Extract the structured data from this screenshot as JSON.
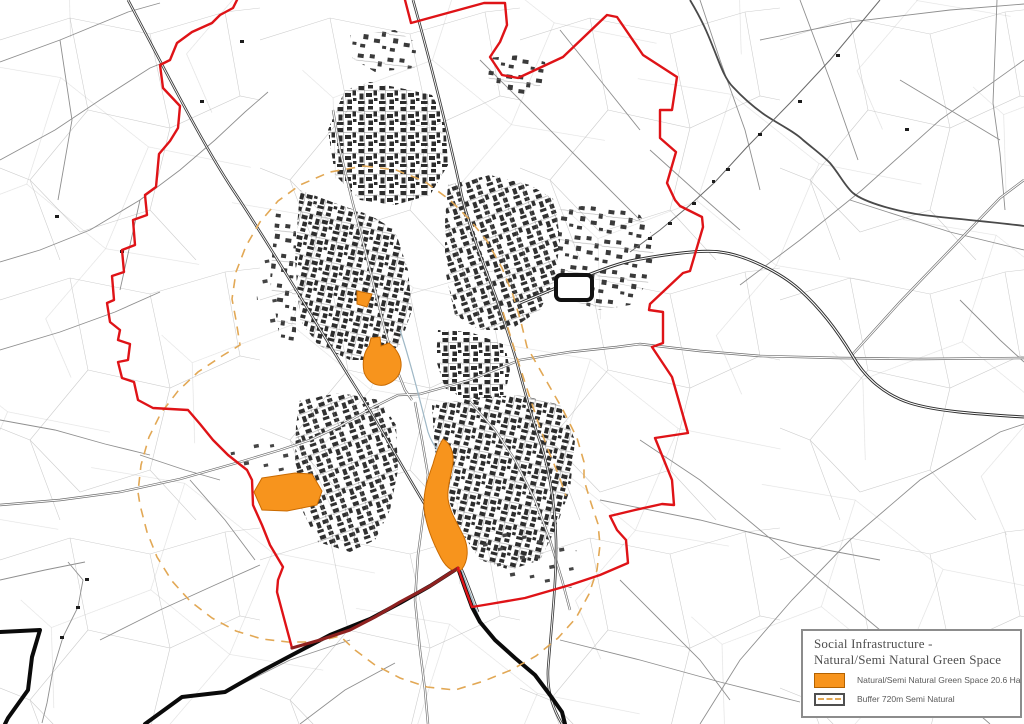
{
  "legend": {
    "title_line1": "Social Infrastructure -",
    "title_line2": "Natural/Semi Natural Green Space",
    "items": [
      {
        "label": "Natural/Semi Natural Green Space 20.6 Ha"
      },
      {
        "label": "Buffer 720m Semi Natural"
      }
    ]
  },
  "colors": {
    "green_space_fill": "#F7941D",
    "green_space_border": "#C96A00",
    "boundary_red": "#DF1317",
    "boundary_railway_overlap": "#8E2120",
    "buffer_dash": "#E2A855",
    "railway_black": "#0A0A0A"
  }
}
